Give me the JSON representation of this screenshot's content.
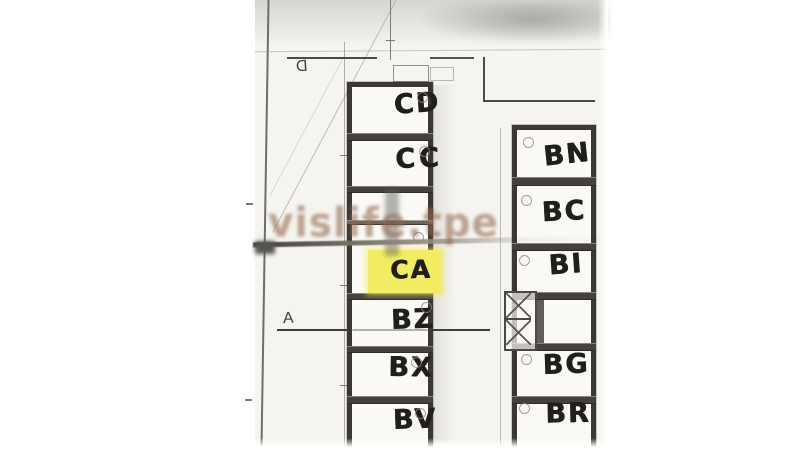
{
  "scan": {
    "watermark": "vislife.tpe",
    "markers": {
      "d": "D",
      "a": "A"
    },
    "left_rooms": [
      {
        "label": "CD"
      },
      {
        "label": "CC"
      },
      {
        "label": "CA",
        "highlighted": true
      },
      {
        "label": "BZ"
      },
      {
        "label": "BX"
      },
      {
        "label": "BV"
      }
    ],
    "right_rooms": [
      {
        "label": "BN"
      },
      {
        "label": "BC"
      },
      {
        "label": "BI"
      },
      {
        "label": "BG"
      },
      {
        "label": "BR"
      }
    ],
    "highlight_color": "#f1ec62",
    "watermark_color": "#94684c"
  }
}
